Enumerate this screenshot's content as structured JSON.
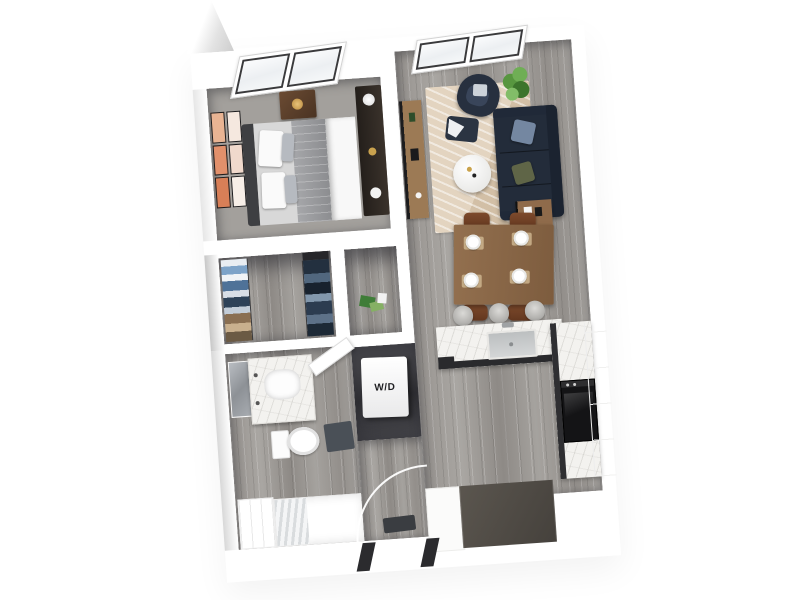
{
  "scene": {
    "description": "3D top-down dollhouse rendering of a one-bedroom apartment floor plan on a white background"
  },
  "floorplan": {
    "labels": {
      "washer_dryer": "W/D"
    },
    "rooms": [
      "bedroom",
      "living-room",
      "walk-in-closet",
      "hall-closet",
      "laundry-closet",
      "bathroom",
      "entry",
      "dining-area",
      "kitchen"
    ],
    "furniture": [
      "bed",
      "nightstand",
      "dresser",
      "wall-art",
      "skylight-window",
      "sofa",
      "armchair",
      "ottoman",
      "plant",
      "coffee-table",
      "media-console",
      "side-table",
      "rug",
      "dining-table",
      "dining-chairs",
      "bar-stools",
      "kitchen-island",
      "sink",
      "oven",
      "tall-cabinets",
      "entry-cabinets",
      "washer-dryer",
      "vanity",
      "mirror",
      "toilet",
      "bathtub",
      "bath-mat",
      "linen-closet",
      "door-swing-arc",
      "doormat"
    ],
    "colors": {
      "background": "#ffffff",
      "walls": "#ffffff",
      "wall_shadow": "#d6d6d6",
      "floor_gray_wood": "#a09d99",
      "sofa_navy": "#232c3a",
      "pillow_slate": "#7487a1",
      "pillow_olive": "#5f6547",
      "rug_beige": "#dccbb6",
      "wood_furniture": "#8f6b4b",
      "dining_chair_leather": "#76452a",
      "plant_green": "#4e8c3c",
      "art_peach": "#e2906b",
      "marble": "#f3f2ef",
      "island_base_charcoal": "#2a2a2d",
      "oven_black": "#141416",
      "entry_cabinet_taupe": "#55504a",
      "bath_mat_slate": "#4a5057",
      "clothes_navy": "#2a3442"
    }
  }
}
